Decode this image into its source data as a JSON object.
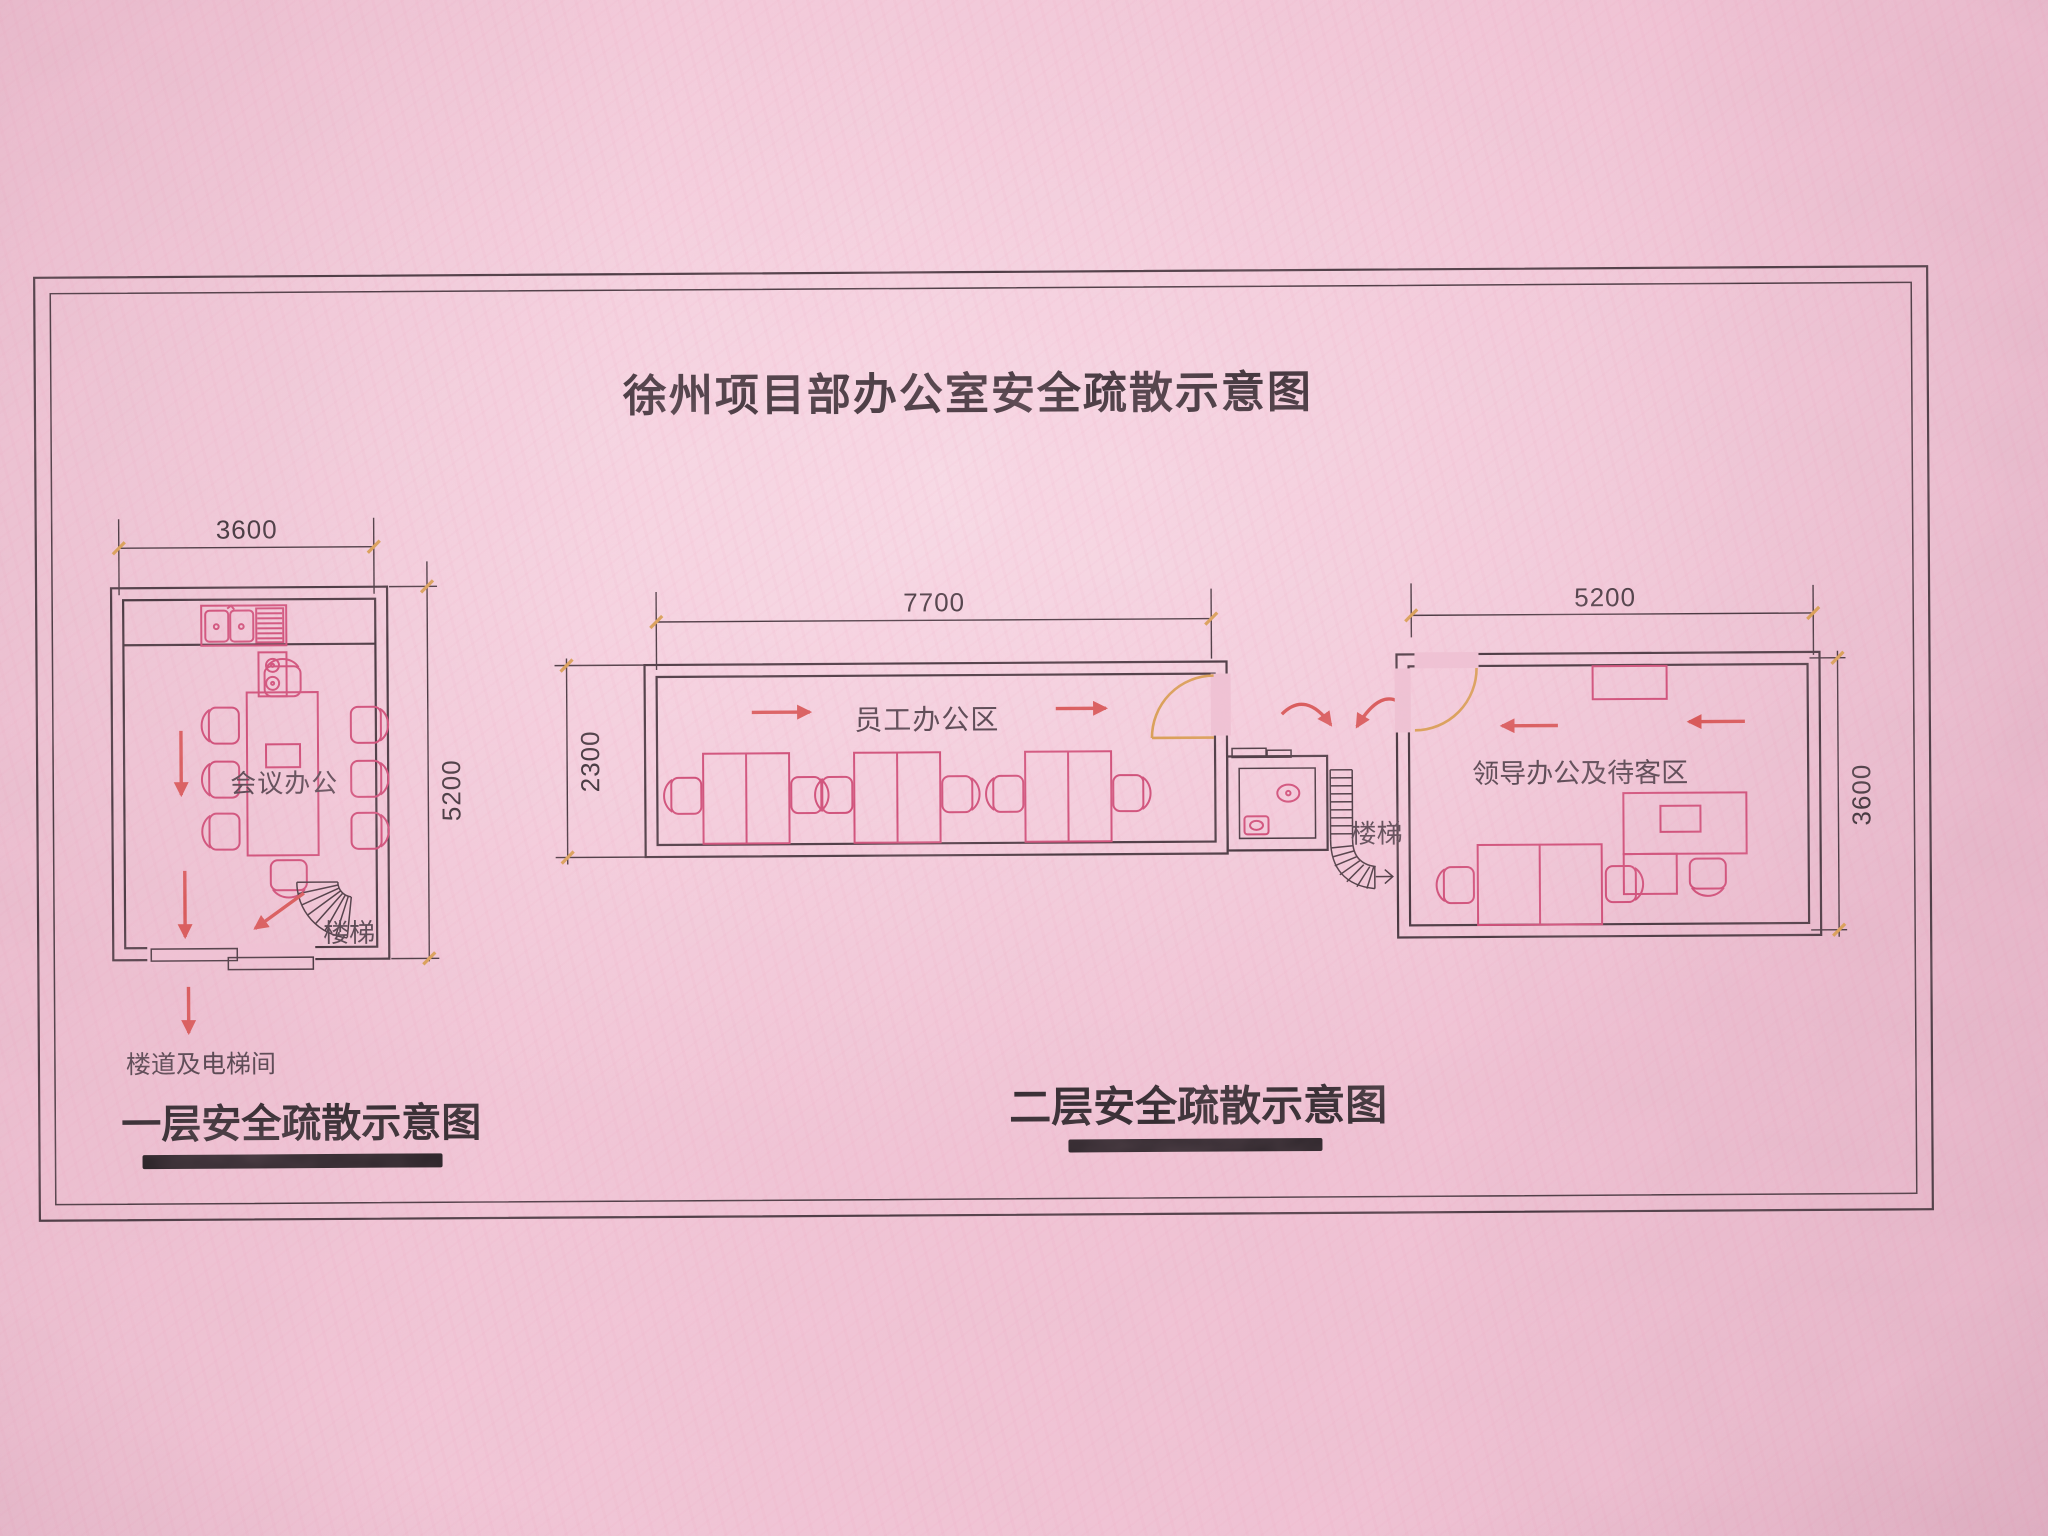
{
  "title": "徐州项目部办公室安全疏散示意图",
  "floor1": {
    "heading": "一层安全疏散示意图",
    "room_label": "会议办公",
    "stairs_label": "楼梯",
    "corridor_label": "楼道及电梯间",
    "dims": {
      "width": "3600",
      "height": "5200"
    }
  },
  "floor2": {
    "heading": "二层安全疏散示意图",
    "staff_room_label": "员工办公区",
    "leader_room_label": "领导办公及待客区",
    "stairs_label": "楼梯",
    "dims": {
      "staff_width": "7700",
      "staff_height": "2300",
      "leader_width": "5200",
      "leader_height": "3600"
    }
  },
  "colors": {
    "paper": "#eec2d3",
    "line_dark": "#4a3a42",
    "furniture_pink": "#cf5079",
    "arrow_red": "#d85a5a",
    "door_orange": "#d9a057",
    "text_dark": "#473a41",
    "label": "#564650"
  }
}
